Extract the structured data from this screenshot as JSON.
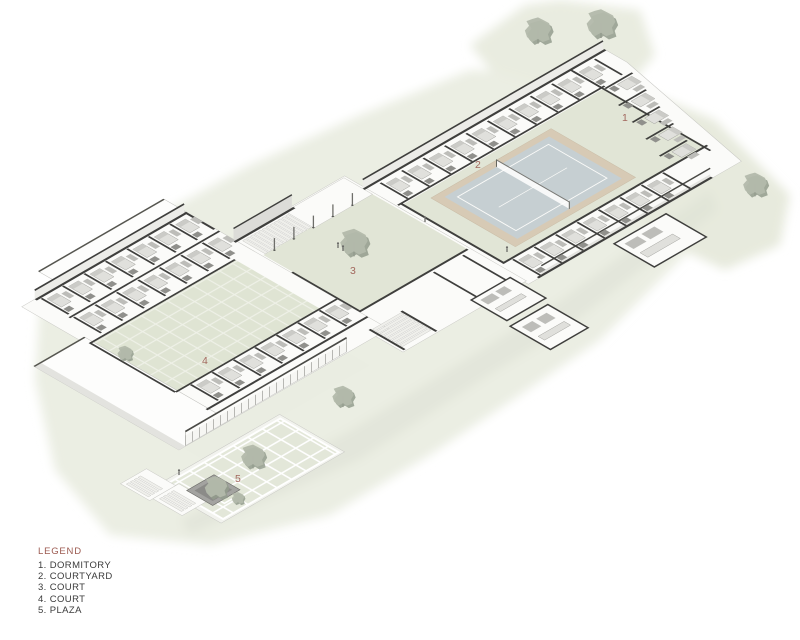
{
  "legend": {
    "title": "LEGEND",
    "items": [
      "1. DORMITORY",
      "2. COURTYARD",
      "3. COURT",
      "4. COURT",
      "5. PLAZA"
    ]
  },
  "plan_labels": [
    {
      "text": "1"
    },
    {
      "text": "2"
    },
    {
      "text": "3"
    },
    {
      "text": "4"
    },
    {
      "text": "5"
    }
  ],
  "colors": {
    "accent": "#9c5a50",
    "site_green": "#eaede2",
    "court_green": "#e1e5d6",
    "tennis_blue": "#c6cfd2",
    "tennis_apron": "#d7cab5",
    "wall_dark": "#3f3f3d"
  }
}
